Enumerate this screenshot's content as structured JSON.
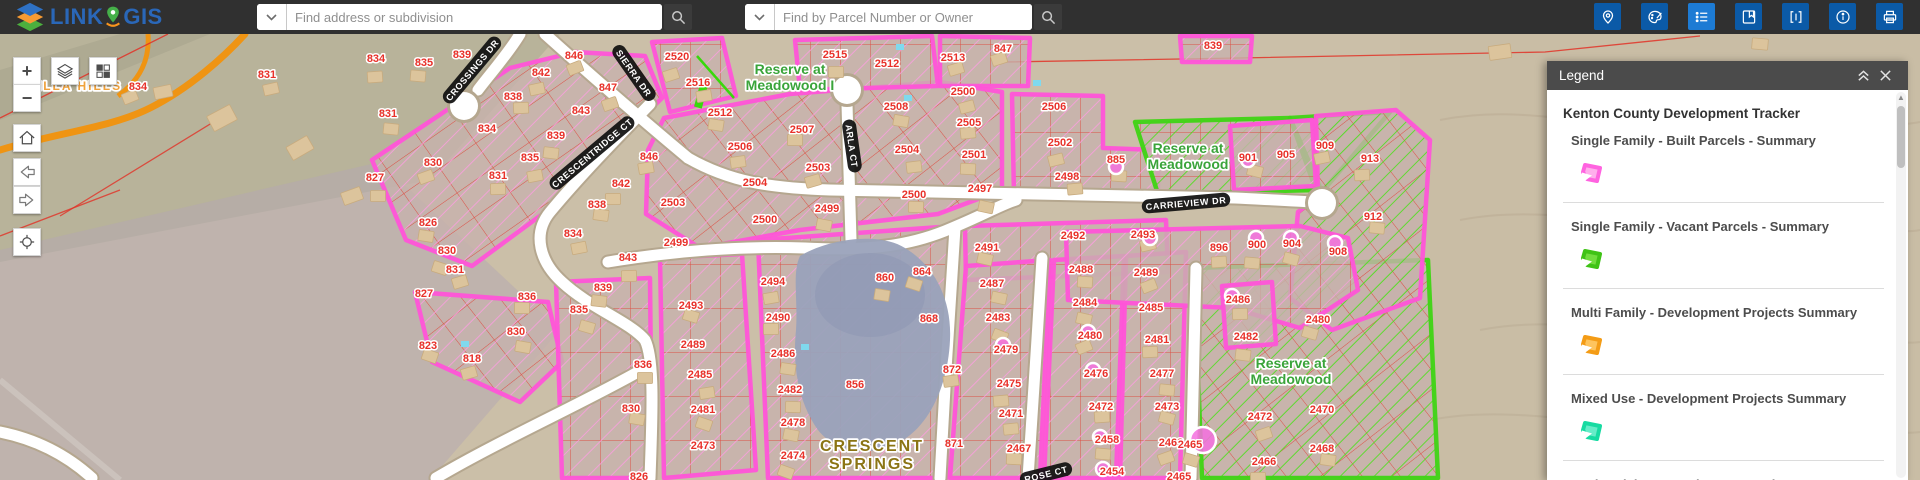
{
  "header": {
    "logo": {
      "word1": "LINK",
      "word2": "GIS"
    },
    "search_address": {
      "placeholder": "Find address or subdivision"
    },
    "search_parcel": {
      "placeholder": "Find by Parcel Number or Owner"
    },
    "tools": [
      {
        "name": "locate-icon",
        "active": false
      },
      {
        "name": "draw-palette-icon",
        "active": false
      },
      {
        "name": "legend-list-icon",
        "active": true
      },
      {
        "name": "bookmarks-icon",
        "active": false
      },
      {
        "name": "code-brackets-icon",
        "active": false
      },
      {
        "name": "info-icon",
        "active": false
      },
      {
        "name": "print-icon",
        "active": false
      }
    ]
  },
  "map_controls": [
    "zoom-in",
    "zoom-out",
    "layers",
    "basemap-grid",
    "home",
    "back",
    "forward",
    "find-location"
  ],
  "map": {
    "place_labels": [
      {
        "lines": [
          "VILLA HILLS"
        ],
        "x": 75,
        "y": 90,
        "color": "#f0a23c",
        "size": 12,
        "spacing": 2
      },
      {
        "lines": [
          "Reserve at",
          "Meadowood I"
        ],
        "x": 790,
        "y": 74,
        "color": "#3aa43a",
        "size": 14,
        "spacing": 0
      },
      {
        "lines": [
          "Reserve at",
          "Meadowood"
        ],
        "x": 1188,
        "y": 153,
        "color": "#3aa43a",
        "size": 14,
        "spacing": 0
      },
      {
        "lines": [
          "Reserve at",
          "Meadowood"
        ],
        "x": 1291,
        "y": 368,
        "color": "#3aa43a",
        "size": 14,
        "spacing": 0
      },
      {
        "lines": [
          "CRESCENT",
          "SPRINGS"
        ],
        "x": 872,
        "y": 451,
        "color": "#8b7414",
        "size": 16,
        "spacing": 2
      }
    ],
    "street_labels": [
      {
        "t": "CROSSINGS DR",
        "x": 472,
        "y": 70,
        "r": -50
      },
      {
        "t": "SIERRA DR",
        "x": 634,
        "y": 73,
        "r": 55
      },
      {
        "t": "CRESCENTRIDGE CT",
        "x": 592,
        "y": 153,
        "r": -40
      },
      {
        "t": "ARLA CT",
        "x": 852,
        "y": 146,
        "r": 82
      },
      {
        "t": "CARRIEVIEW DR",
        "x": 1186,
        "y": 203,
        "r": -5
      },
      {
        "t": "ROSE CT",
        "x": 1046,
        "y": 474,
        "r": -14
      }
    ],
    "parcel_numbers": [
      [
        "834",
        138,
        86
      ],
      [
        "831",
        267,
        74
      ],
      [
        "834",
        376,
        58
      ],
      [
        "835",
        424,
        62
      ],
      [
        "839",
        462,
        54
      ],
      [
        "846",
        574,
        55
      ],
      [
        "842",
        541,
        72
      ],
      [
        "838",
        513,
        96
      ],
      [
        "831",
        388,
        113
      ],
      [
        "834",
        487,
        128
      ],
      [
        "830",
        433,
        162
      ],
      [
        "835",
        530,
        157
      ],
      [
        "831",
        498,
        175
      ],
      [
        "839",
        556,
        135
      ],
      [
        "843",
        581,
        110
      ],
      [
        "847",
        608,
        87
      ],
      [
        "846",
        649,
        156
      ],
      [
        "842",
        621,
        183
      ],
      [
        "838",
        597,
        204
      ],
      [
        "2503",
        673,
        202
      ],
      [
        "2520",
        677,
        56
      ],
      [
        "2516",
        698,
        82
      ],
      [
        "2515",
        835,
        54
      ],
      [
        "2512",
        720,
        112
      ],
      [
        "2512",
        887,
        63
      ],
      [
        "2513",
        953,
        57
      ],
      [
        "2506",
        740,
        146
      ],
      [
        "2507",
        802,
        129
      ],
      [
        "2508",
        896,
        106
      ],
      [
        "2504",
        755,
        182
      ],
      [
        "2503",
        818,
        167
      ],
      [
        "2504",
        907,
        149
      ],
      [
        "2500",
        914,
        194
      ],
      [
        "2499",
        827,
        208
      ],
      [
        "2500",
        765,
        219
      ],
      [
        "2500",
        963,
        91
      ],
      [
        "2505",
        969,
        122
      ],
      [
        "2501",
        974,
        154
      ],
      [
        "2497",
        980,
        188
      ],
      [
        "2506",
        1054,
        106
      ],
      [
        "2502",
        1060,
        142
      ],
      [
        "2498",
        1067,
        176
      ],
      [
        "885",
        1116,
        159
      ],
      [
        "2491",
        987,
        247
      ],
      [
        "2492",
        1073,
        235
      ],
      [
        "2493",
        1143,
        234
      ],
      [
        "896",
        1219,
        247
      ],
      [
        "900",
        1257,
        244
      ],
      [
        "901",
        1248,
        157
      ],
      [
        "905",
        1286,
        154
      ],
      [
        "909",
        1325,
        145
      ],
      [
        "913",
        1370,
        158
      ],
      [
        "912",
        1373,
        216
      ],
      [
        "904",
        1292,
        243
      ],
      [
        "908",
        1338,
        251
      ],
      [
        "834",
        573,
        233
      ],
      [
        "843",
        628,
        257
      ],
      [
        "839",
        603,
        287
      ],
      [
        "835",
        579,
        309
      ],
      [
        "2499",
        676,
        242
      ],
      [
        "2494",
        773,
        281
      ],
      [
        "2490",
        778,
        317
      ],
      [
        "2486",
        783,
        353
      ],
      [
        "2493",
        691,
        305
      ],
      [
        "2489",
        693,
        344
      ],
      [
        "2485",
        700,
        374
      ],
      [
        "836",
        643,
        364
      ],
      [
        "860",
        885,
        277
      ],
      [
        "864",
        922,
        271
      ],
      [
        "868",
        929,
        318
      ],
      [
        "872",
        952,
        369
      ],
      [
        "856",
        855,
        384
      ],
      [
        "830",
        631,
        408
      ],
      [
        "2481",
        703,
        409
      ],
      [
        "2473",
        703,
        445
      ],
      [
        "826",
        639,
        476
      ],
      [
        "2482",
        790,
        389
      ],
      [
        "2478",
        793,
        422
      ],
      [
        "2474",
        793,
        455
      ],
      [
        "871",
        954,
        443
      ],
      [
        "2471",
        1011,
        413
      ],
      [
        "2467",
        1019,
        448
      ],
      [
        "2487",
        992,
        283
      ],
      [
        "2483",
        998,
        317
      ],
      [
        "2479",
        1006,
        349
      ],
      [
        "2475",
        1009,
        383
      ],
      [
        "2488",
        1081,
        269
      ],
      [
        "2484",
        1085,
        302
      ],
      [
        "2480",
        1090,
        335
      ],
      [
        "2476",
        1096,
        373
      ],
      [
        "2472",
        1101,
        406
      ],
      [
        "2458",
        1107,
        439
      ],
      [
        "2454",
        1112,
        471
      ],
      [
        "2489",
        1146,
        272
      ],
      [
        "2485",
        1151,
        307
      ],
      [
        "2481",
        1157,
        339
      ],
      [
        "2477",
        1162,
        373
      ],
      [
        "2473",
        1167,
        406
      ],
      [
        "2468",
        1171,
        442
      ],
      [
        "2465",
        1179,
        476
      ],
      [
        "2486",
        1238,
        299
      ],
      [
        "2482",
        1246,
        336
      ],
      [
        "2480",
        1318,
        319
      ],
      [
        "2472",
        1260,
        416
      ],
      [
        "2470",
        1322,
        409
      ],
      [
        "2466",
        1264,
        461
      ],
      [
        "2468",
        1322,
        448
      ],
      [
        "2465",
        1190,
        444
      ],
      [
        "847",
        1003,
        48
      ],
      [
        "839",
        1213,
        45
      ],
      [
        "827",
        375,
        177
      ],
      [
        "826",
        428,
        222
      ],
      [
        "830",
        447,
        250
      ],
      [
        "831",
        455,
        269
      ],
      [
        "827",
        424,
        293
      ],
      [
        "836",
        527,
        296
      ],
      [
        "830",
        516,
        331
      ],
      [
        "823",
        428,
        345
      ],
      [
        "818",
        472,
        358
      ]
    ],
    "pink_dots": [
      [
        1116,
        167
      ],
      [
        1150,
        238
      ],
      [
        1248,
        160
      ],
      [
        1256,
        238
      ],
      [
        1291,
        238
      ],
      [
        1335,
        243
      ],
      [
        1003,
        345
      ],
      [
        1088,
        332
      ],
      [
        1093,
        370
      ],
      [
        1100,
        437
      ],
      [
        1103,
        469
      ],
      [
        1232,
        296
      ],
      [
        1203,
        440,
        13
      ]
    ]
  },
  "legend": {
    "header": "Legend",
    "group_title": "Kenton County Development Tracker",
    "items": [
      {
        "label": "Single Family - Built Parcels - Summary",
        "stroke": "#ff63e0",
        "fill": "#ffaeec"
      },
      {
        "label": "Single Family - Vacant Parcels - Summary",
        "stroke": "#3fc316",
        "fill": "#71dd3e"
      },
      {
        "label": "Multi Family - Development Projects Summary",
        "stroke": "#f49c16",
        "fill": "#fec45e"
      },
      {
        "label": "Mixed Use - Development Projects Summary",
        "stroke": "#17dba2",
        "fill": "#67ecc8"
      },
      {
        "label": "Senior Living - Development Projects Summary"
      }
    ]
  }
}
